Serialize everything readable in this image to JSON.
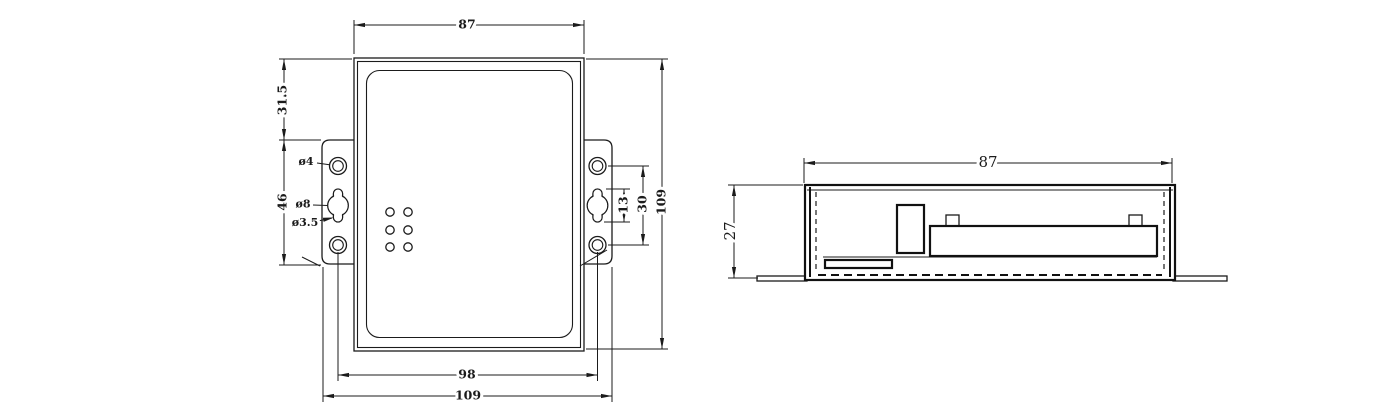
{
  "drawing": {
    "colors": {
      "line": "#1b1b1b",
      "background": "#ffffff"
    },
    "front_view": {
      "dims": {
        "body_width": "87",
        "ear_top_offset": "31.5",
        "ear_height": "46",
        "small_hole_dia": "ø4",
        "keyhole_dia": "ø8",
        "slot_dia": "ø3.5",
        "slot_length": "13",
        "hole_pitch": "30",
        "overall_height": "109",
        "hole_span": "98",
        "overall_width": "109"
      }
    },
    "side_view": {
      "dims": {
        "body_width": "87",
        "body_height": "27"
      }
    }
  }
}
